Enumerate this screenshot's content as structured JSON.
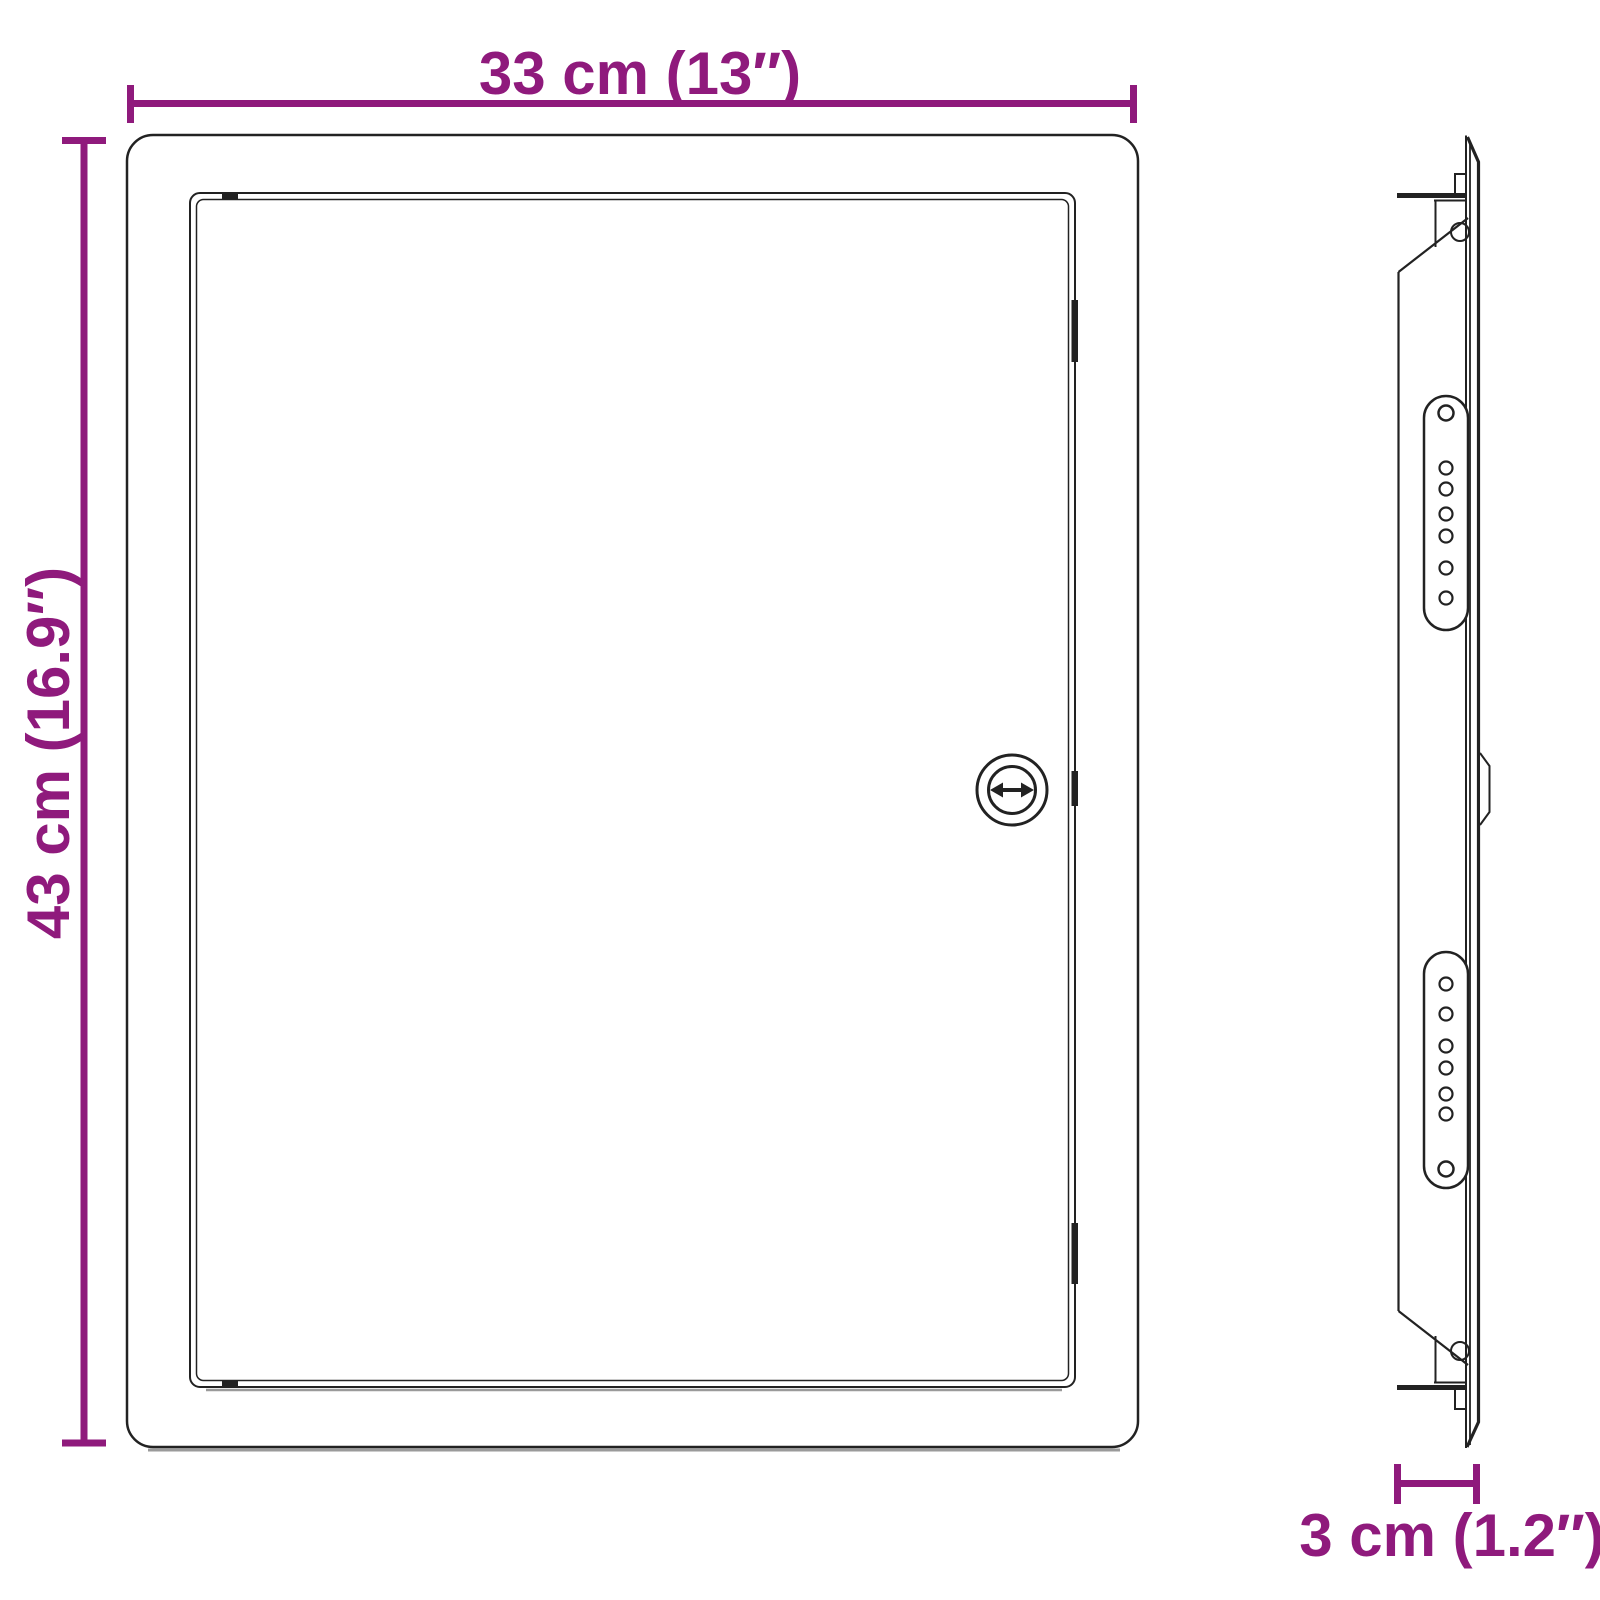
{
  "colors": {
    "accent": "#8F1A7C",
    "ink": "#222222",
    "shadow": "#9a9a9a"
  },
  "dimensions": {
    "width": {
      "label": "33 cm (13″)"
    },
    "height": {
      "label": "43 cm (16.9″)"
    },
    "depth": {
      "label": "3 cm (1.2″)"
    }
  }
}
